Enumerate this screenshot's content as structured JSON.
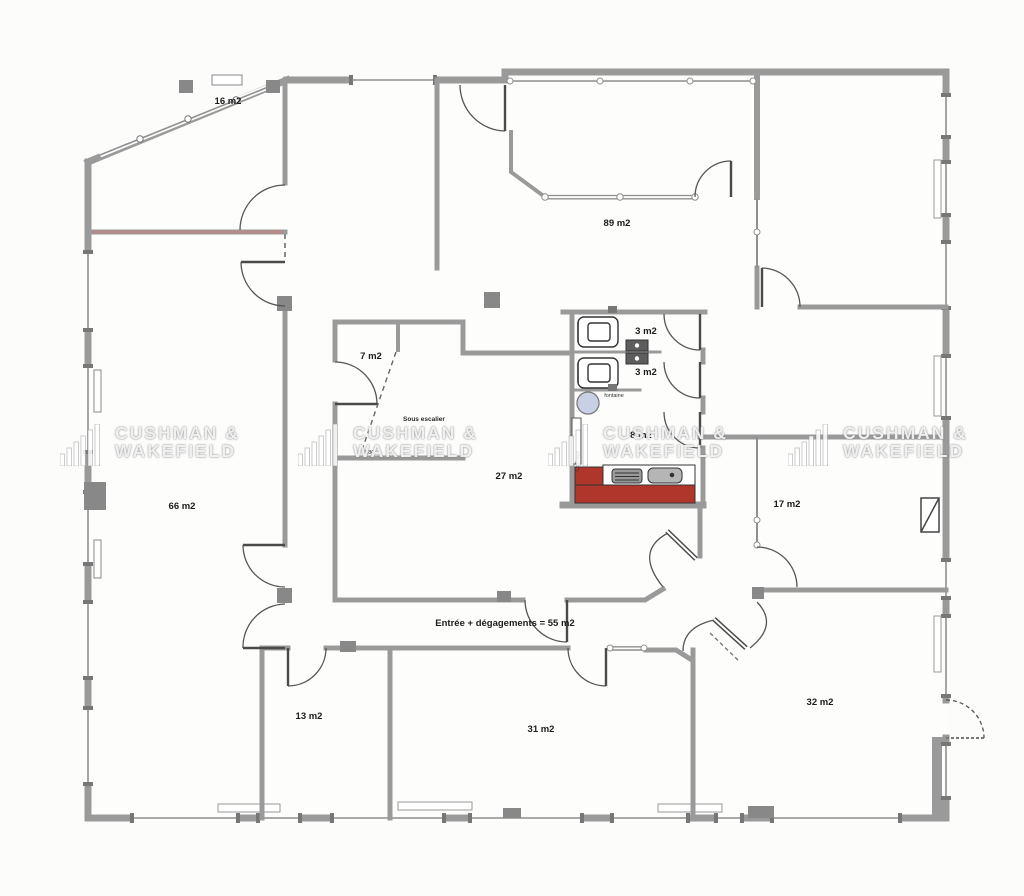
{
  "labels": {
    "room_16": "16 m2",
    "room_89": "89 m2",
    "room_7": "7 m2",
    "sous_escalier": "Sous escalier",
    "room_3a": "3 m2",
    "room_3b": "3 m2",
    "fontaine": "fontaine",
    "room_8": "8 m2",
    "room_27": "27 m2",
    "room_66": "66 m2",
    "room_17": "17 m2",
    "entree": "Entrée + dégagements = 55 m2",
    "room_13": "13 m2",
    "room_31": "31 m2",
    "room_32": "32 m2",
    "coffrage": "Coffrage",
    "dim_sous_escalier": "1,80"
  },
  "watermark": {
    "line1": "CUSHMAN &",
    "line2": "WAKEFIELD"
  },
  "colors": {
    "kitchen_red": "#b0352b",
    "fountain_fill": "#c7d0e4",
    "wall_gray": "#9a9a9a"
  }
}
